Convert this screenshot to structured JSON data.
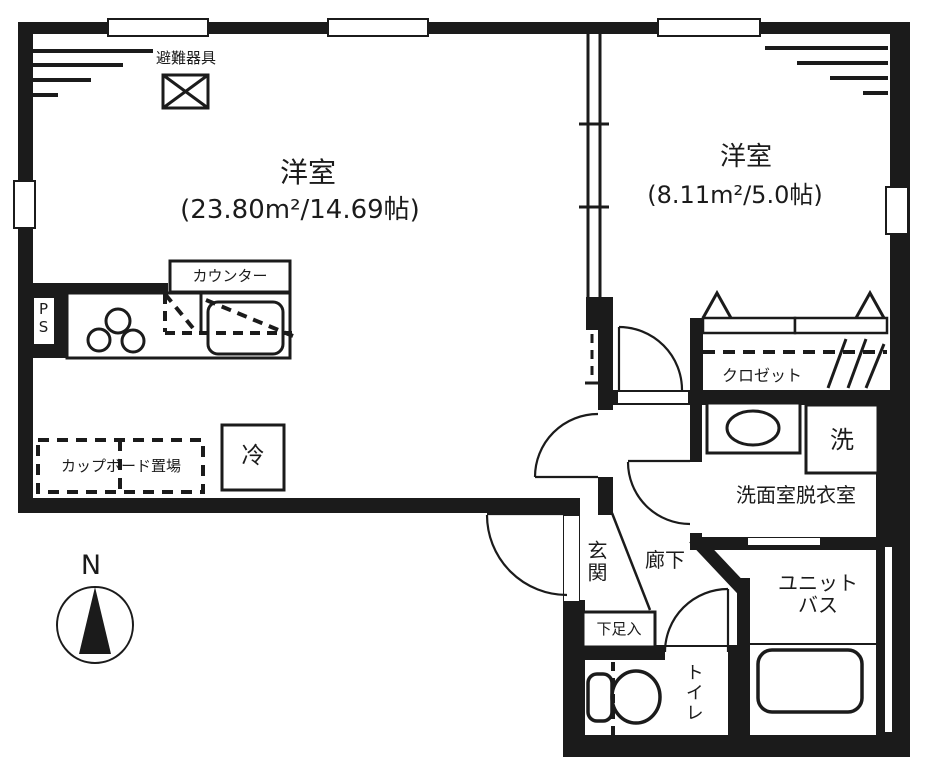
{
  "plan": {
    "evacuation_label": "避難器具",
    "room_main": {
      "name": "洋室",
      "area": "(23.80m²/14.69帖)"
    },
    "room_second": {
      "name": "洋室",
      "area": "(8.11m²/5.0帖)"
    },
    "kitchen": {
      "counter": "カウンター",
      "pipe_space": "PS",
      "cupboard": "カップボード置場",
      "fridge": "冷"
    },
    "closet": "クロゼット",
    "washroom": {
      "name": "洗面室脱衣室",
      "washer": "洗"
    },
    "entrance": {
      "genkan": "玄関",
      "hallway": "廊下",
      "shoe_box": "下足入"
    },
    "bath": "ユニットバス",
    "toilet": "トイレ",
    "compass": "N",
    "colors": {
      "wall": "#1b1b1b",
      "background": "#ffffff"
    }
  }
}
